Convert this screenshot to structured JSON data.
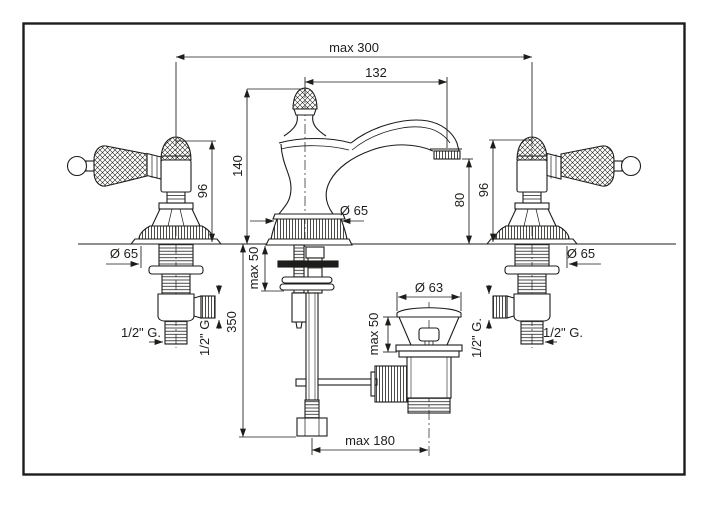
{
  "colors": {
    "line": "#1d1d1b",
    "background": "#ffffff"
  },
  "drawing": {
    "dimensions": {
      "overall_width": "max 300",
      "spout_reach": "132",
      "spout_top_height": "140",
      "handle_height_left": "96",
      "handle_height_right": "96",
      "outlet_height": "80",
      "base_dia_left": "Ø 65",
      "base_dia_center": "Ø 65",
      "base_dia_right": "Ø 65",
      "deck_max_center": "max 50",
      "deck_max_drain": "max 50",
      "below_deck_depth": "350",
      "drain_dia": "Ø 63",
      "rod_reach": "max 180",
      "thread_left_inlet": "1/2\" G.",
      "thread_left_outlet": "1/2\" G.",
      "thread_right_outlet": "1/2\" G.",
      "thread_right_inlet": "1/2\" G."
    }
  }
}
